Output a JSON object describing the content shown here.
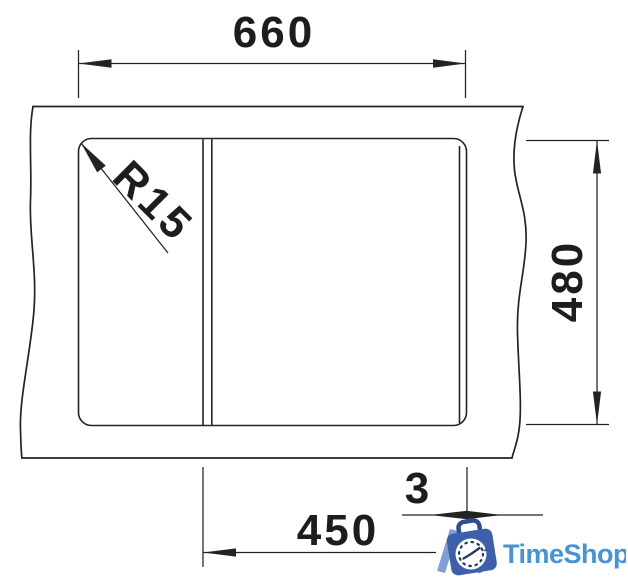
{
  "drawing": {
    "line_color": "#232323",
    "dims": {
      "top_width": "660",
      "right_depth": "480",
      "bottom_bowl_width": "450",
      "gap": "3",
      "corner_radius": "R15"
    }
  },
  "logo": {
    "text": "TimeShop",
    "text_color": "#4594da",
    "bag_color": "#3d60aa",
    "handle_color": "#2d4d97",
    "slash_color": "#7fa0d4",
    "clock_face_color": "#ffffff",
    "clock_marks_color": "#1e3a66"
  }
}
